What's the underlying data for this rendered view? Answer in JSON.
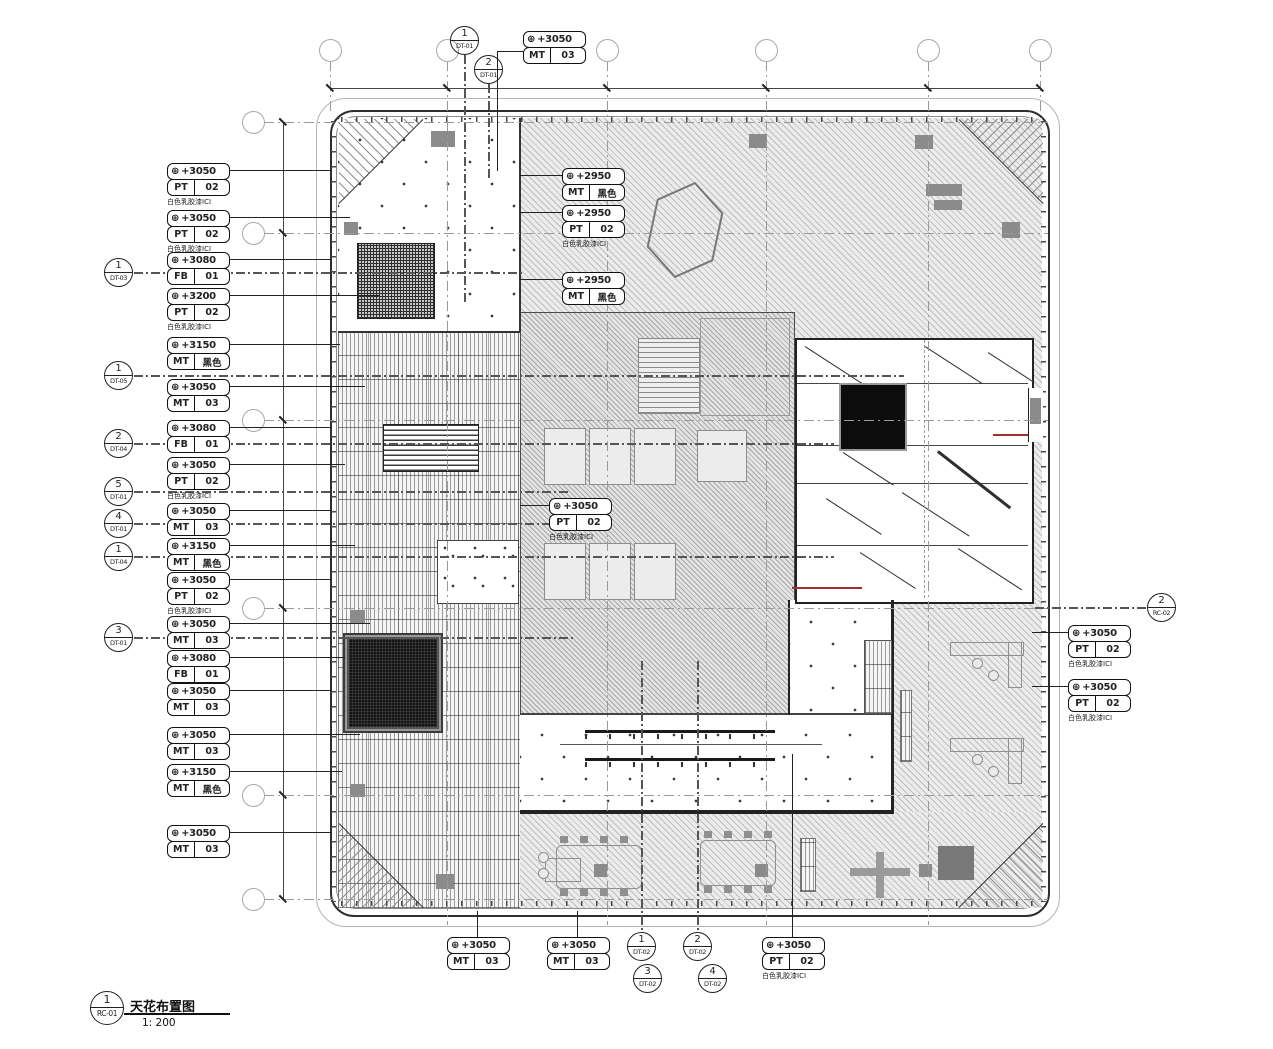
{
  "colors": {
    "accent_red": "#a03030"
  },
  "icons": {
    "elevation_target": "⊕"
  },
  "title_block": {
    "number": "1",
    "sheet": "RC-01",
    "title": "天花布置图",
    "scale": "1: 200"
  },
  "grid_top": [
    {
      "label": "2",
      "css": {
        "left": "319px",
        "top": "39px"
      }
    },
    {
      "label": "3",
      "css": {
        "left": "436px",
        "top": "39px"
      }
    },
    {
      "label": "4",
      "css": {
        "left": "596px",
        "top": "39px"
      }
    },
    {
      "label": "5",
      "css": {
        "left": "755px",
        "top": "39px"
      }
    },
    {
      "label": "6",
      "css": {
        "left": "917px",
        "top": "39px"
      }
    },
    {
      "label": "7",
      "css": {
        "left": "1029px",
        "top": "39px"
      }
    }
  ],
  "grid_left": [
    {
      "label": "F",
      "css": {
        "left": "242px",
        "top": "111px"
      }
    },
    {
      "label": "E",
      "css": {
        "left": "242px",
        "top": "222px"
      }
    },
    {
      "label": "D",
      "css": {
        "left": "242px",
        "top": "409px"
      }
    },
    {
      "label": "C",
      "css": {
        "left": "242px",
        "top": "597px"
      }
    },
    {
      "label": "B",
      "css": {
        "left": "242px",
        "top": "784px"
      }
    },
    {
      "label": "A",
      "css": {
        "left": "242px",
        "top": "888px"
      }
    }
  ],
  "dims_top": [
    {
      "text": "6250",
      "css": {
        "left": "367px",
        "top": "72px"
      }
    },
    {
      "text": "9000",
      "css": {
        "left": "505px",
        "top": "72px"
      }
    },
    {
      "text": "9000",
      "css": {
        "left": "665px",
        "top": "72px"
      }
    },
    {
      "text": "9000",
      "css": {
        "left": "825px",
        "top": "72px"
      }
    },
    {
      "text": "6250",
      "css": {
        "left": "962px",
        "top": "72px"
      }
    }
  ],
  "dims_left": [
    {
      "text": "6250",
      "css": {
        "left": "260px",
        "top": "171px"
      }
    },
    {
      "text": "10500",
      "css": {
        "left": "260px",
        "top": "320px"
      }
    },
    {
      "text": "10500",
      "css": {
        "left": "260px",
        "top": "507px"
      }
    },
    {
      "text": "10500",
      "css": {
        "left": "260px",
        "top": "695px"
      }
    },
    {
      "text": "6250",
      "css": {
        "left": "260px",
        "top": "840px"
      }
    }
  ],
  "minor_dims": [
    {
      "text": "1480",
      "css": {
        "left": "573px",
        "top": "736px"
      }
    },
    {
      "text": "1330",
      "css": {
        "left": "788px",
        "top": "736px"
      }
    }
  ],
  "tags": [
    {
      "elev": "+3050",
      "code": "PT",
      "val": "02",
      "cap": "白色乳胶漆ICI",
      "css": {
        "left": "167px",
        "top": "163px"
      },
      "h": {
        "left": "63px",
        "top": "7px",
        "width": "102px"
      }
    },
    {
      "elev": "+3050",
      "code": "PT",
      "val": "02",
      "cap": "白色乳胶漆ICI",
      "css": {
        "left": "167px",
        "top": "210px"
      },
      "h": {
        "left": "63px",
        "top": "7px",
        "width": "120px"
      }
    },
    {
      "elev": "+3080",
      "code": "FB",
      "val": "01",
      "css": {
        "left": "167px",
        "top": "252px"
      },
      "h": {
        "left": "63px",
        "top": "7px",
        "width": "102px"
      }
    },
    {
      "elev": "+3200",
      "code": "PT",
      "val": "02",
      "cap": "白色乳胶漆ICI",
      "css": {
        "left": "167px",
        "top": "288px"
      },
      "h": {
        "left": "63px",
        "top": "7px",
        "width": "150px"
      }
    },
    {
      "elev": "+3150",
      "code": "MT",
      "val": "黑色",
      "css": {
        "left": "167px",
        "top": "337px"
      },
      "h": {
        "left": "63px",
        "top": "7px",
        "width": "110px"
      }
    },
    {
      "elev": "+3050",
      "code": "MT",
      "val": "03",
      "css": {
        "left": "167px",
        "top": "379px"
      },
      "h": {
        "left": "63px",
        "top": "7px",
        "width": "135px"
      }
    },
    {
      "elev": "+3080",
      "code": "FB",
      "val": "01",
      "css": {
        "left": "167px",
        "top": "420px"
      },
      "h": {
        "left": "63px",
        "top": "7px",
        "width": "102px"
      }
    },
    {
      "elev": "+3050",
      "code": "PT",
      "val": "02",
      "cap": "白色乳胶漆ICI",
      "css": {
        "left": "167px",
        "top": "457px"
      },
      "h": {
        "left": "63px",
        "top": "7px",
        "width": "115px"
      }
    },
    {
      "elev": "+3050",
      "code": "MT",
      "val": "03",
      "css": {
        "left": "167px",
        "top": "503px"
      },
      "h": {
        "left": "63px",
        "top": "7px",
        "width": "102px"
      }
    },
    {
      "elev": "+3150",
      "code": "MT",
      "val": "黑色",
      "css": {
        "left": "167px",
        "top": "538px"
      },
      "h": {
        "left": "63px",
        "top": "7px",
        "width": "125px"
      }
    },
    {
      "elev": "+3050",
      "code": "PT",
      "val": "02",
      "cap": "白色乳胶漆ICI",
      "css": {
        "left": "167px",
        "top": "572px"
      },
      "h": {
        "left": "63px",
        "top": "7px",
        "width": "102px"
      }
    },
    {
      "elev": "+3050",
      "code": "MT",
      "val": "03",
      "css": {
        "left": "167px",
        "top": "616px"
      },
      "h": {
        "left": "63px",
        "top": "7px",
        "width": "140px"
      }
    },
    {
      "elev": "+3080",
      "code": "FB",
      "val": "01",
      "css": {
        "left": "167px",
        "top": "650px"
      },
      "h": {
        "left": "63px",
        "top": "7px",
        "width": "115px"
      }
    },
    {
      "elev": "+3050",
      "code": "MT",
      "val": "03",
      "css": {
        "left": "167px",
        "top": "683px"
      },
      "h": {
        "left": "63px",
        "top": "7px",
        "width": "102px"
      }
    },
    {
      "elev": "+3050",
      "code": "MT",
      "val": "03",
      "css": {
        "left": "167px",
        "top": "727px"
      },
      "h": {
        "left": "63px",
        "top": "7px",
        "width": "130px"
      }
    },
    {
      "elev": "+3150",
      "code": "MT",
      "val": "黑色",
      "css": {
        "left": "167px",
        "top": "764px"
      },
      "h": {
        "left": "63px",
        "top": "7px",
        "width": "112px"
      }
    },
    {
      "elev": "+3050",
      "code": "MT",
      "val": "03",
      "css": {
        "left": "167px",
        "top": "825px"
      },
      "h": {
        "left": "63px",
        "top": "7px",
        "width": "102px"
      }
    },
    {
      "elev": "+3050",
      "code": "MT",
      "val": "03",
      "css": {
        "left": "523px",
        "top": "31px"
      },
      "h": {
        "left": "-26px",
        "top": "20px",
        "width": "26px"
      },
      "v": {
        "left": "-26px",
        "top": "20px",
        "height": "120px"
      }
    },
    {
      "elev": "+2950",
      "code": "MT",
      "val": "黑色",
      "css": {
        "left": "562px",
        "top": "168px"
      },
      "h": {
        "left": "-42px",
        "top": "7px",
        "width": "42px"
      }
    },
    {
      "elev": "+2950",
      "code": "PT",
      "val": "02",
      "cap": "白色乳胶漆ICI",
      "css": {
        "left": "562px",
        "top": "205px"
      },
      "h": {
        "left": "-42px",
        "top": "7px",
        "width": "42px"
      }
    },
    {
      "elev": "+2950",
      "code": "MT",
      "val": "黑色",
      "css": {
        "left": "562px",
        "top": "272px"
      },
      "h": {
        "left": "-42px",
        "top": "7px",
        "width": "42px"
      }
    },
    {
      "elev": "+3050",
      "code": "PT",
      "val": "02",
      "cap": "白色乳胶漆ICI",
      "css": {
        "left": "549px",
        "top": "498px"
      },
      "h": {
        "left": "-29px",
        "top": "7px",
        "width": "29px"
      }
    },
    {
      "elev": "+3050",
      "code": "PT",
      "val": "02",
      "cap": "白色乳胶漆ICI",
      "css": {
        "left": "1068px",
        "top": "625px"
      },
      "h": {
        "left": "-36px",
        "top": "7px",
        "width": "36px"
      }
    },
    {
      "elev": "+3050",
      "code": "PT",
      "val": "02",
      "cap": "白色乳胶漆ICI",
      "css": {
        "left": "1068px",
        "top": "679px"
      },
      "h": {
        "left": "-36px",
        "top": "7px",
        "width": "36px"
      }
    },
    {
      "elev": "+3050",
      "code": "MT",
      "val": "03",
      "css": {
        "left": "447px",
        "top": "937px"
      },
      "v": {
        "left": "30px",
        "top": "-26px",
        "height": "26px"
      }
    },
    {
      "elev": "+3050",
      "code": "MT",
      "val": "03",
      "css": {
        "left": "547px",
        "top": "937px"
      },
      "v": {
        "left": "30px",
        "top": "-26px",
        "height": "26px"
      }
    },
    {
      "elev": "+3050",
      "code": "PT",
      "val": "02",
      "cap": "白色乳胶漆ICI",
      "css": {
        "left": "762px",
        "top": "937px"
      },
      "v": {
        "left": "30px",
        "top": "-183px",
        "height": "183px"
      }
    }
  ],
  "markers": [
    {
      "num": "1",
      "ref": "DT-03",
      "css": {
        "left": "104px",
        "top": "258px"
      },
      "h": {
        "left": "29px",
        "top": "13px",
        "width": "390px"
      }
    },
    {
      "num": "1",
      "ref": "DT-05",
      "css": {
        "left": "104px",
        "top": "361px"
      },
      "h": {
        "left": "29px",
        "top": "13px",
        "width": "770px"
      }
    },
    {
      "num": "2",
      "ref": "DT-04",
      "css": {
        "left": "104px",
        "top": "429px"
      },
      "h": {
        "left": "29px",
        "top": "13px",
        "width": "700px"
      }
    },
    {
      "num": "5",
      "ref": "DT-01",
      "css": {
        "left": "104px",
        "top": "477px"
      },
      "h": {
        "left": "29px",
        "top": "13px",
        "width": "435px"
      }
    },
    {
      "num": "4",
      "ref": "DT-01",
      "css": {
        "left": "104px",
        "top": "509px"
      },
      "h": {
        "left": "29px",
        "top": "13px",
        "width": "435px"
      }
    },
    {
      "num": "1",
      "ref": "DT-04",
      "css": {
        "left": "104px",
        "top": "542px"
      },
      "h": {
        "left": "29px",
        "top": "13px",
        "width": "700px"
      }
    },
    {
      "num": "3",
      "ref": "DT-01",
      "css": {
        "left": "104px",
        "top": "623px"
      },
      "h": {
        "left": "29px",
        "top": "13px",
        "width": "440px"
      }
    },
    {
      "num": "1",
      "ref": "DT-01",
      "css": {
        "left": "450px",
        "top": "26px"
      },
      "v": {
        "left": "13px",
        "top": "28px",
        "height": "250px"
      }
    },
    {
      "num": "2",
      "ref": "DT-01",
      "css": {
        "left": "474px",
        "top": "55px"
      },
      "v": {
        "left": "13px",
        "top": "28px",
        "height": "95px"
      }
    },
    {
      "num": "1",
      "ref": "DT-02",
      "css": {
        "left": "627px",
        "top": "932px"
      },
      "v": {
        "left": "13px",
        "top": "-272px",
        "height": "272px"
      }
    },
    {
      "num": "2",
      "ref": "DT-02",
      "css": {
        "left": "683px",
        "top": "932px"
      },
      "v": {
        "left": "13px",
        "top": "-272px",
        "height": "272px"
      }
    },
    {
      "num": "3",
      "ref": "DT-02",
      "css": {
        "left": "633px",
        "top": "964px"
      }
    },
    {
      "num": "4",
      "ref": "DT-02",
      "css": {
        "left": "698px",
        "top": "964px"
      }
    },
    {
      "num": "2",
      "ref": "RC-02",
      "css": {
        "left": "1147px",
        "top": "593px"
      },
      "h": {
        "left": "-113px",
        "top": "13px",
        "width": "113px"
      }
    }
  ],
  "watermarks": [
    {
      "text": "易",
      "css": {
        "left": "4px",
        "top": "22px",
        "fontSize": "46px"
      }
    },
    {
      "text": "易",
      "css": {
        "left": "0px",
        "top": "132px",
        "fontSize": "38px",
        "opacity": "0.7"
      }
    },
    {
      "text": "易",
      "css": {
        "left": "2px",
        "top": "912px",
        "fontSize": "44px"
      }
    },
    {
      "text": "易",
      "css": {
        "left": "1232px",
        "top": "118px",
        "fontSize": "46px"
      }
    },
    {
      "text": "易",
      "css": {
        "left": "1232px",
        "top": "540px",
        "fontSize": "46px"
      }
    },
    {
      "text": "易",
      "css": {
        "left": "1230px",
        "top": "924px",
        "fontSize": "46px"
      }
    },
    {
      "text": "yitu.cn",
      "css": {
        "left": "1222px",
        "top": "360px",
        "transform": "rotate(90deg)"
      }
    },
    {
      "text": "yitu.cn",
      "css": {
        "left": "58px",
        "top": "330px",
        "transform": "rotate(-35deg)"
      }
    },
    {
      "text": "yitu.cn",
      "css": {
        "left": "82px",
        "top": "800px",
        "transform": "rotate(-35deg)"
      }
    },
    {
      "text": "yitu.cn",
      "css": {
        "left": "1192px",
        "top": "700px",
        "transform": "rotate(-35deg)",
        "fontSize": "15px"
      }
    },
    {
      "text": "yitu.cn",
      "css": {
        "left": "150px",
        "top": "992px",
        "transform": "rotate(-35deg)"
      }
    },
    {
      "text": "易",
      "css": {
        "left": "640px",
        "top": "352px",
        "fontSize": "60px",
        "color": "rgba(255,255,255,0.55)"
      }
    },
    {
      "text": "易",
      "css": {
        "left": "452px",
        "top": "540px",
        "fontSize": "58px",
        "color": "rgba(210,210,210,0.5)"
      }
    },
    {
      "text": "易图网",
      "css": {
        "left": "938px",
        "top": "824px",
        "fontSize": "80px",
        "letterSpacing": "8px",
        "color": "rgba(188,188,188,0.55)"
      }
    }
  ]
}
